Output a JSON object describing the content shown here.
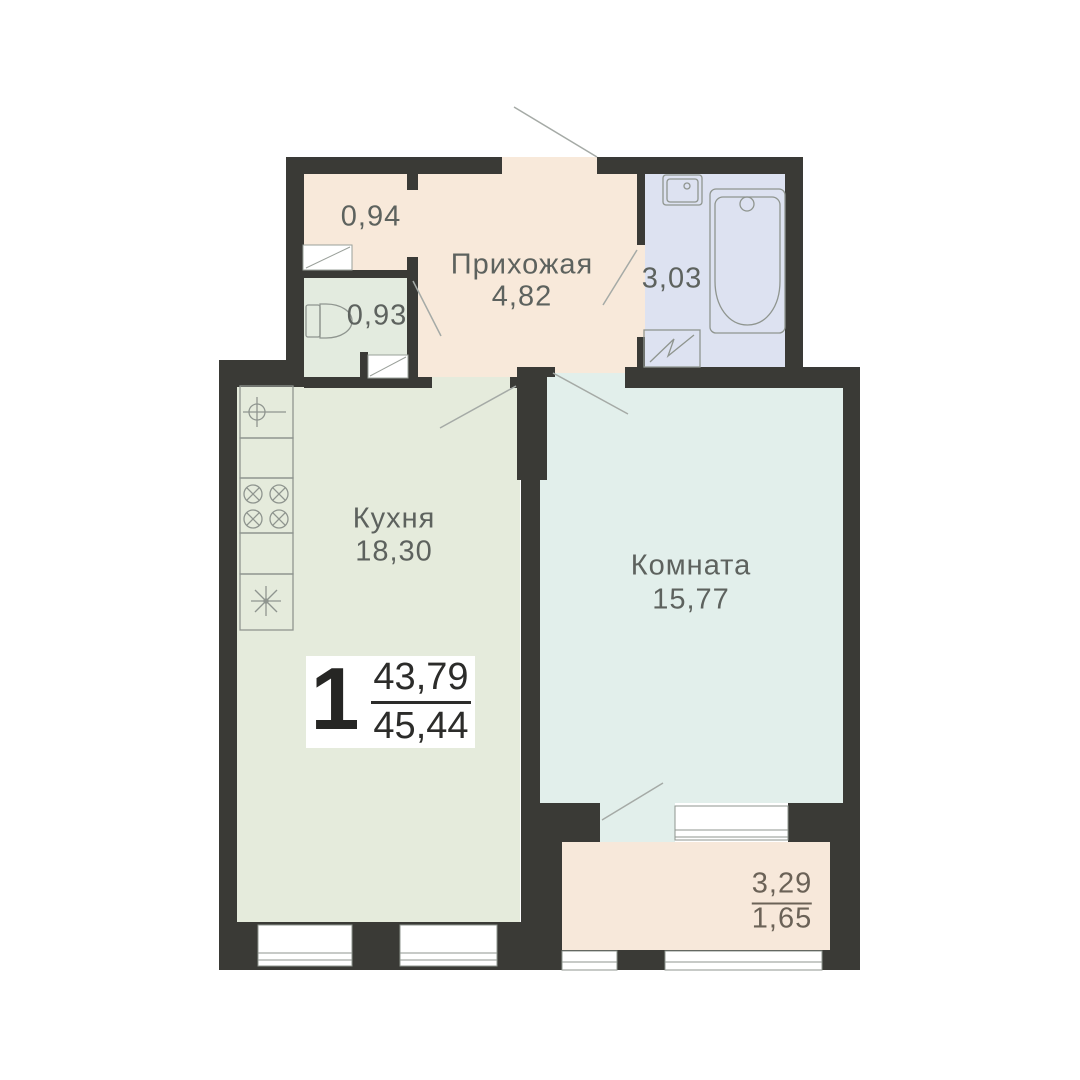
{
  "plan": {
    "title_badge": {
      "rooms_count": "1",
      "living_area": "43,79",
      "total_area": "45,44"
    },
    "rooms": {
      "closet": {
        "area": "0,94"
      },
      "wc": {
        "area": "0,93"
      },
      "hallway": {
        "name": "Прихожая",
        "area": "4,82"
      },
      "bathroom": {
        "area": "3,03"
      },
      "kitchen": {
        "name": "Кухня",
        "area": "18,30"
      },
      "living_room": {
        "name": "Комната",
        "area": "15,77"
      },
      "balcony": {
        "area_full": "3,29",
        "area_counted": "1,65"
      }
    },
    "colors": {
      "wall": "#3a3a36",
      "hallway_floor": "#f8e9da",
      "closet_floor": "#f8e9da",
      "wc_floor": "#e3ebdf",
      "bathroom_floor": "#dde2f1",
      "kitchen_floor": "#e5ebdc",
      "living_room_floor": "#e2efeb",
      "balcony_floor": "#f7e8da",
      "fixture_line": "#8f958f",
      "door_swing_line": "#a5aaa6",
      "label_text": "#5d625e",
      "balcony_text": "#6b6257",
      "badge_text": "#2c2c2a"
    },
    "icons": [
      "bathtub-icon",
      "bath-sink-icon",
      "washing-machine-icon",
      "toilet-icon",
      "kitchen-sink-icon",
      "stove-icon",
      "fridge-icon",
      "door-swing-icon",
      "window-icon"
    ]
  }
}
